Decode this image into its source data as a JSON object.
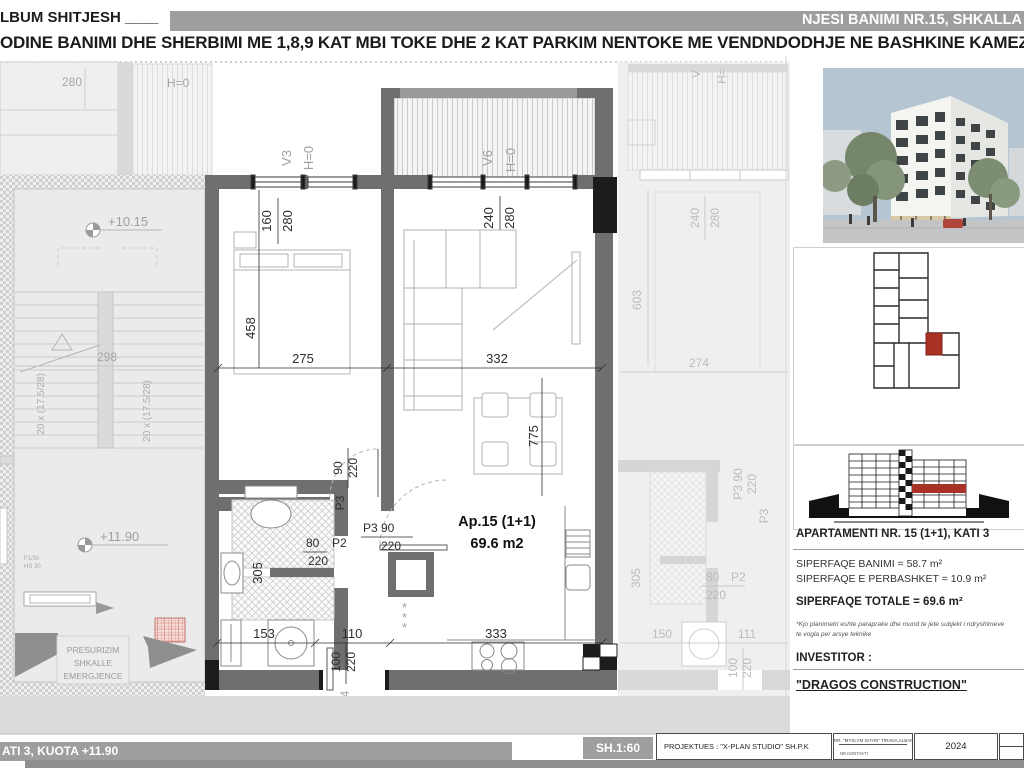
{
  "header": {
    "album_title": "LBUM SHITJESH ____",
    "banner_title": "NJESI BANIMI NR.15, SHKALLA",
    "subtitle": "ODINE BANIMI DHE SHERBIMI ME 1,8,9 KAT MBI TOKE DHE 2 KAT PARKIM NENTOKE ME VENDNDODHJE NE BASHKINE KAMEZ"
  },
  "plan": {
    "ap_label": "Ap.15 (1+1)",
    "ap_area": "69.6 m2",
    "d275": "275",
    "d332": "332",
    "d458": "458",
    "d775": "775",
    "d153": "153",
    "d110": "110",
    "d333": "333",
    "d305": "305",
    "d298": "298",
    "d280": "280",
    "d603": "603",
    "d274": "274",
    "d150": "150",
    "d111": "111",
    "d6": "6",
    "v3": "V3",
    "v6": "V6",
    "h0": "H=0",
    "vR": "V",
    "hR": "H=",
    "w160": "160",
    "w240": "240",
    "w280": "280",
    "p2": "P2",
    "p3": "P3",
    "p4": "P4",
    "d80": "80",
    "d90": "90",
    "d100": "100",
    "d220": "220",
    "p3_90": "P3  90",
    "lvl_upper": "+10.15",
    "lvl_current": "+11.90",
    "stair_note": "20 x (17.5/28)",
    "pres1": "PRESURIZIM",
    "pres2": "SHKALLE",
    "pres3": "EMERGJENCE",
    "fnote1": "F1/30",
    "fnote2": "HS 30",
    "ast": "*"
  },
  "sidebar": {
    "info_title": "APARTAMENTI NR. 15 (1+1), KATI 3",
    "line1": "SIPERFAQE BANIMI = 58.7 m²",
    "line2": "SIPERFAQE E PERBASHKET = 10.9 m²",
    "total": "SIPERFAQE TOTALE = 69.6 m²",
    "note1": "*Kjo planimetri eshte paraprake dhe mund te jete subjekt i ndryshimeve",
    "note2": "te vogla per arsye teknike",
    "investor_label": "INVESTITOR :",
    "investor_name": "\"DRAGOS CONSTRUCTION\""
  },
  "footer": {
    "left": "ATI 3, KUOTA +11.90",
    "scale": "SH.1:60",
    "projektues": "PROJEKTUES :  \"X-PLAN STUDIO\" SH.P.K",
    "stamp_line1": "RR. \"MYSLYM SHYRI\" TIRANA,ALBANIA",
    "stamp_line2": "NR.KONTAKTI",
    "year": "2024"
  }
}
